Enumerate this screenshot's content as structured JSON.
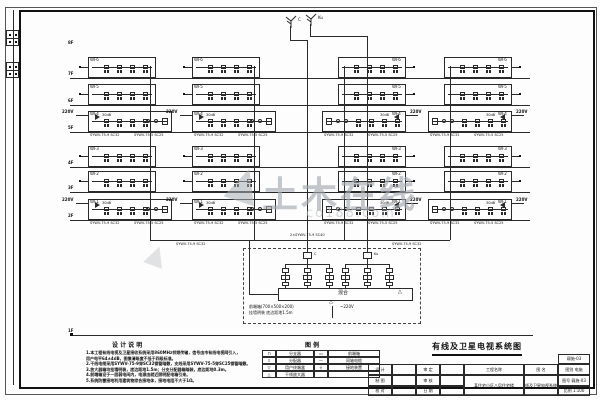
{
  "drawing_title": "有线及卫星电视系统图",
  "watermark": {
    "main": "土木在线",
    "sub": "co188.com"
  },
  "antennas": [
    {
      "label": "C"
    },
    {
      "label": "Ku"
    }
  ],
  "floors": [
    {
      "y": 47,
      "label": "8F",
      "line": false
    },
    {
      "y": 78,
      "label": "7F",
      "line": true
    },
    {
      "y": 105,
      "label": "6F",
      "line": true
    },
    {
      "y": 132,
      "label": "5F",
      "line": true
    },
    {
      "y": 167,
      "label": "4F",
      "line": true
    },
    {
      "y": 192,
      "label": "3F",
      "line": true
    },
    {
      "y": 220,
      "label": "2F",
      "line": true
    },
    {
      "y": 335,
      "label": "1F",
      "line": true,
      "x2": 533
    }
  ],
  "grid": {
    "rows": [
      {
        "y": 57,
        "type": "n",
        "label": "WF6"
      },
      {
        "y": 84,
        "type": "n",
        "label": "WF5"
      },
      {
        "y": 111,
        "type": "w",
        "label": "WF4"
      },
      {
        "y": 146,
        "type": "n",
        "label": "WF3"
      },
      {
        "y": 171,
        "type": "n",
        "label": "WF2"
      },
      {
        "y": 199,
        "type": "w",
        "label": "WF1"
      }
    ],
    "cols": [
      {
        "x": 88,
        "wx": 88,
        "side": "L"
      },
      {
        "x": 192,
        "wx": 192,
        "side": "L"
      },
      {
        "x": 338,
        "wx": 322,
        "side": "R"
      },
      {
        "x": 444,
        "wx": 428,
        "side": "R"
      }
    ],
    "nw": 68,
    "ww": 84,
    "ph": 21,
    "power_label": "220V",
    "amp_label": "30dB",
    "cable_a": "SYWV-75-9 SC32",
    "cable_b": "SYWV-75-5 SC25"
  },
  "risers": [
    {
      "x": 150,
      "y1": 66,
      "y2": 240
    },
    {
      "x": 254,
      "y1": 66,
      "y2": 240
    },
    {
      "x": 344,
      "y1": 66,
      "y2": 240
    },
    {
      "x": 450,
      "y1": 66,
      "y2": 240
    }
  ],
  "links": [
    {
      "y": 240,
      "x1": 150,
      "x2": 450
    },
    {
      "x": 249,
      "y1": 240,
      "y2": 294
    },
    {
      "y": 294,
      "x1": 249,
      "x2": 278
    },
    {
      "x": 290,
      "y1": 26,
      "y2": 40
    },
    {
      "y": 40,
      "x1": 290,
      "x2": 307
    },
    {
      "x": 307,
      "y1": 40,
      "y2": 252
    },
    {
      "x": 310,
      "y1": 24,
      "y2": 36
    },
    {
      "y": 36,
      "x1": 310,
      "x2": 367
    },
    {
      "x": 367,
      "y1": 36,
      "y2": 252
    }
  ],
  "cable_tags": [
    {
      "x": 176,
      "y": 242,
      "t": "SYWV-75-9 SC32"
    },
    {
      "x": 290,
      "y": 233,
      "t": "2×SYWV-75-9 SC40"
    },
    {
      "x": 392,
      "y": 242,
      "t": "SYWV-75-9 SC32"
    }
  ],
  "headend": {
    "box": {
      "x": 243,
      "y": 248,
      "w": 178,
      "h": 76
    },
    "feeds": [
      {
        "x": 307,
        "label": "C"
      },
      {
        "x": 367,
        "label": "Ku"
      }
    ],
    "offsets": [
      -22,
      0,
      22
    ],
    "mixer": "混合",
    "ground": "△",
    "arrow_note1": "前端箱(700×500×200)",
    "arrow_note2": "挂墙明装 底边距地1.5m",
    "power": "~220V"
  },
  "notes": {
    "title": "设 计 说 明",
    "lines": [
      "1.本工程有线电视及卫星接收系统采用860MHz邻频传输，信号由市有线电视网引入，",
      "  用户电平64±4dB，图像清晰度不低于四级标准。",
      "2.干线电缆采用SYWV-75-9穿SC32钢管暗敷，支线采用SYWV-75-5穿SC25钢管暗敷。",
      "3.放大器箱均挂墙明装，底边距地1.5m；分支分配器箱暗装，底边距地0.3m。",
      "4.前端箱设于一层弱电间内，电源由就近照明配电箱引来。",
      "5.系统防雷接地利用建筑物综合接地体，接地电阻不大于1Ω。"
    ]
  },
  "legend": {
    "title": "图 例",
    "rows": [
      [
        "⊓",
        "分支器",
        "▭",
        "前端箱"
      ],
      [
        "⌑",
        "分配器",
        "—",
        "同轴电缆"
      ],
      [
        "▽",
        "用户终端盒",
        "⏚",
        "接地装置"
      ],
      [
        "△",
        "干线放大器",
        "",
        ""
      ]
    ]
  },
  "titleblock": {
    "topbox": "弱施-03",
    "cells": [
      {
        "x": 368,
        "y": 364,
        "w": 24,
        "h": 11,
        "t": "设 计"
      },
      {
        "x": 368,
        "y": 375,
        "w": 24,
        "h": 11,
        "t": "制 图"
      },
      {
        "x": 368,
        "y": 386,
        "w": 24,
        "h": 10,
        "t": "校 对"
      },
      {
        "x": 392,
        "y": 364,
        "w": 24,
        "h": 11,
        "t": ""
      },
      {
        "x": 392,
        "y": 375,
        "w": 24,
        "h": 11,
        "t": ""
      },
      {
        "x": 392,
        "y": 386,
        "w": 24,
        "h": 10,
        "t": ""
      },
      {
        "x": 416,
        "y": 364,
        "w": 24,
        "h": 11,
        "t": "审 定"
      },
      {
        "x": 416,
        "y": 375,
        "w": 24,
        "h": 11,
        "t": "审 核"
      },
      {
        "x": 416,
        "y": 386,
        "w": 24,
        "h": 10,
        "t": "日 期"
      },
      {
        "x": 440,
        "y": 364,
        "w": 24,
        "h": 11,
        "t": ""
      },
      {
        "x": 440,
        "y": 375,
        "w": 24,
        "h": 11,
        "t": ""
      },
      {
        "x": 440,
        "y": 386,
        "w": 24,
        "h": 10,
        "t": ""
      },
      {
        "x": 464,
        "y": 364,
        "w": 60,
        "h": 11,
        "t": "工程名称"
      },
      {
        "x": 464,
        "y": 375,
        "w": 60,
        "h": 21,
        "t": "某住宅小区八层住宅楼"
      },
      {
        "x": 524,
        "y": 364,
        "w": 34,
        "h": 11,
        "t": "图 名"
      },
      {
        "x": 524,
        "y": 375,
        "w": 34,
        "h": 21,
        "t": "有线及卫星电视系统图"
      },
      {
        "x": 558,
        "y": 364,
        "w": 32,
        "h": 11,
        "t": "图别 电施"
      },
      {
        "x": 558,
        "y": 375,
        "w": 32,
        "h": 11,
        "t": "图号 弱施-03"
      },
      {
        "x": 558,
        "y": 386,
        "w": 32,
        "h": 10,
        "t": "比例 1:100"
      }
    ]
  }
}
